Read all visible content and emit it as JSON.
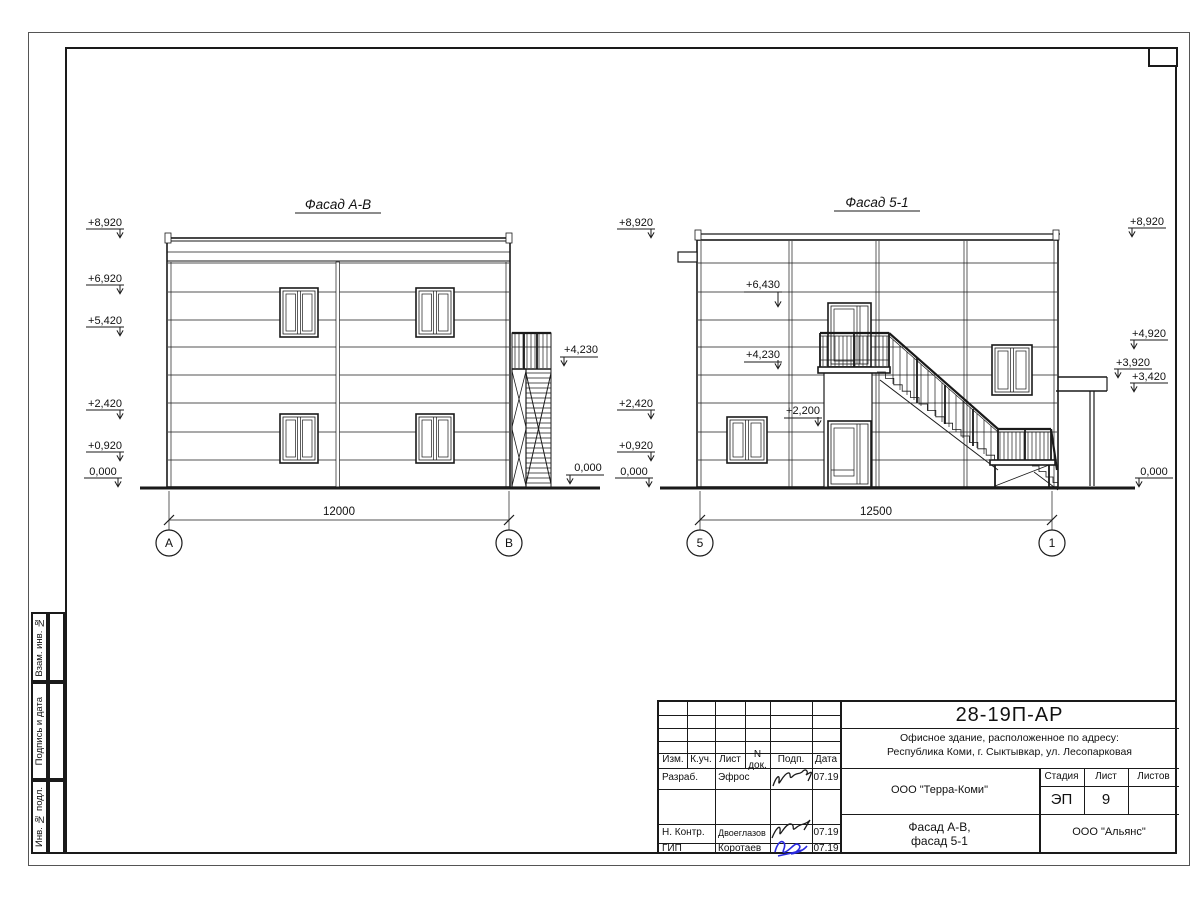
{
  "facade_ab": {
    "title": "Фасад А-В",
    "marks_left": [
      "+8,920",
      "+6,920",
      "+5,420",
      "+2,420",
      "+0,920",
      "0,000"
    ],
    "marks_right": [
      "+4,230",
      "0,000"
    ],
    "dimension": "12000",
    "axis_left": "А",
    "axis_right": "В"
  },
  "facade_51": {
    "title": "Фасад 5-1",
    "marks_left": [
      "+8,920",
      "+2,420",
      "+0,920",
      "0,000"
    ],
    "marks_inner": [
      "+6,430",
      "+4,230",
      "+2,200"
    ],
    "marks_right": [
      "+8,920",
      "+4,920",
      "+3,920",
      "+3,420",
      "0,000"
    ],
    "dimension": "12500",
    "axis_left": "5",
    "axis_right": "1"
  },
  "stamp_sidebar": {
    "items": [
      "Взам. инв. №",
      "Подпись и дата",
      "Инв. № подл."
    ]
  },
  "title_block": {
    "doc_number": "28-19П-АР",
    "address_line1": "Офисное здание, расположенное по адресу:",
    "address_line2": "Республика Коми, г. Сыктывкар, ул. Лесопарковая",
    "columns": [
      "Изм.",
      "К.уч.",
      "Лист",
      "N док.",
      "Подп.",
      "Дата"
    ],
    "rows": [
      {
        "role": "Разраб.",
        "name": "Эфрос",
        "date": "07.19"
      },
      {
        "role": "Н. Контр.",
        "name": "Двоеглазов",
        "date": "07.19"
      },
      {
        "role": "ГИП",
        "name": "Коротаев",
        "date": "07.19"
      }
    ],
    "company": "ООО \"Терра-Коми\"",
    "stage_label": "Стадия",
    "sheet_label": "Лист",
    "sheets_label": "Листов",
    "stage_value": "ЭП",
    "sheet_value": "9",
    "sheets_value": "",
    "subject_line1": "Фасад А-В,",
    "subject_line2": "фасад 5-1",
    "contractor": "ООО \"Альянс\""
  }
}
